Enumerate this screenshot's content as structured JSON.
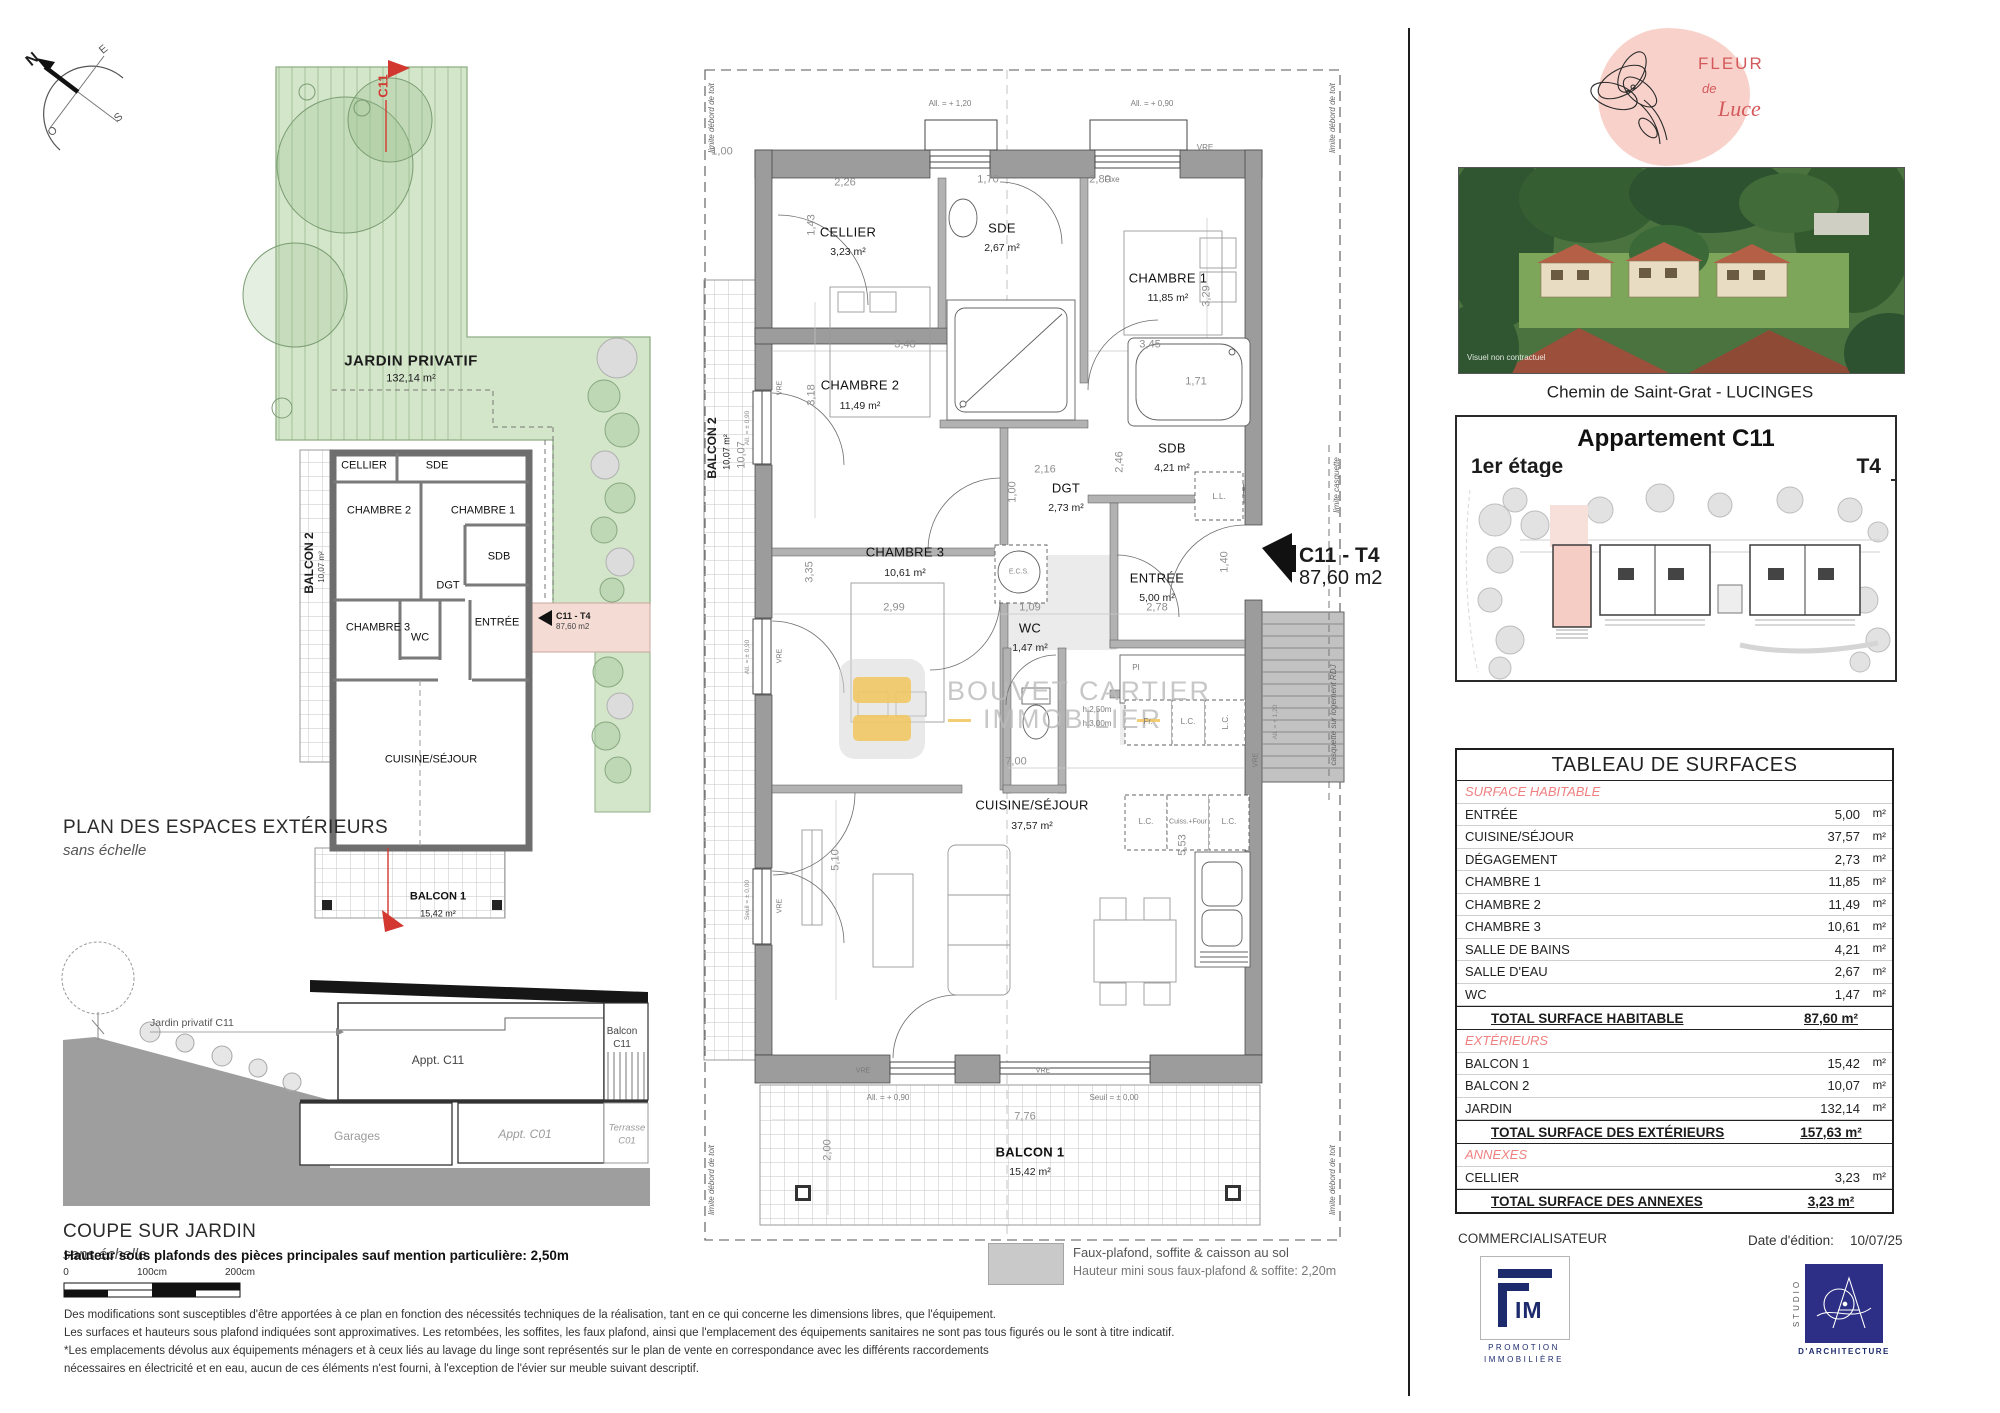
{
  "colors": {
    "accent_red": "#d23730",
    "table_section_pink": "#f08080",
    "wall_gray": "#9c9c9c",
    "jardin_green": "#d4e6ca",
    "brand_pink": "#f8d2ca",
    "brand_red": "#d4595c",
    "navy": "#1d2b6d",
    "watermark_yellow": "#f2c55c"
  },
  "brand": {
    "top": "FLEUR",
    "mid": "de",
    "script": "Luce"
  },
  "project": {
    "photo_note": "Visuel non contractuel",
    "address": "Chemin de Saint-Grat - LUCINGES",
    "title": "Appartement C11",
    "floor": "1er étage",
    "type": "T4"
  },
  "unit_tag": {
    "code": "C11 - T4",
    "area": "87,60 m2"
  },
  "compass": {
    "n": "N",
    "e": "E",
    "s": "S",
    "o": "O"
  },
  "jardin": {
    "title": "JARDIN PRIVATIF",
    "area": "132,14 m²",
    "marker": "C11"
  },
  "ext_plan": {
    "caption": "PLAN DES ESPACES EXTÉRIEURS",
    "scale_note": "sans échelle"
  },
  "coupe": {
    "caption": "COUPE SUR JARDIN",
    "scale_note": "sans échelle",
    "jardin_label": "Jardin privatif C11",
    "appt": "Appt. C11",
    "balcon_l1": "Balcon",
    "balcon_l2": "C11",
    "garages": "Garages",
    "appt_c01": "Appt. C01",
    "terrasse_l1": "Terrasse",
    "terrasse_l2": "C01"
  },
  "rooms": {
    "cellier": {
      "name": "CELLIER",
      "area": "3,23 m²"
    },
    "sde": {
      "name": "SDE",
      "area": "2,67 m²"
    },
    "chambre1": {
      "name": "CHAMBRE 1",
      "area": "11,85 m²"
    },
    "chambre2": {
      "name": "CHAMBRE 2",
      "area": "11,49 m²"
    },
    "sdb": {
      "name": "SDB",
      "area": "4,21 m²"
    },
    "dgt": {
      "name": "DGT",
      "area": "2,73 m²"
    },
    "chambre3": {
      "name": "CHAMBRE 3",
      "area": "10,61 m²"
    },
    "wc": {
      "name": "WC",
      "area": "1,47 m²"
    },
    "entree": {
      "name": "ENTRÉE",
      "area": "5,00 m²"
    },
    "cuisine": {
      "name": "CUISINE/SÉJOUR",
      "area": "37,57 m²"
    },
    "balcon1": {
      "name": "BALCON 1",
      "area": "15,42 m²"
    },
    "balcon2": {
      "name": "BALCON 2",
      "area": "10,07 m²",
      "dim": "10,07"
    }
  },
  "dims": {
    "d100": "1,00",
    "d226": "2,26",
    "d170": "1,70",
    "d280": "2,80",
    "d143": "1,43",
    "d348": "3,48",
    "d345": "3,45",
    "d318": "3,18",
    "d329": "3,29",
    "d171": "1,71",
    "d246": "2,46",
    "d216": "2,16",
    "d299": "2,99",
    "d109": "1,09",
    "d278": "2,78",
    "d140": "1,40",
    "d335": "3,35",
    "d510": "5,10",
    "d700": "7,00",
    "d553": "5,53",
    "d776": "7,76",
    "d200": "2,00"
  },
  "ann": {
    "all120": "All. = + 1,20",
    "all090": "All. = + 0,90",
    "all090pm": "All. = ± 0,90",
    "vre": "VRE",
    "fixe": "Fixe",
    "ecs": "E.C.S.",
    "ll": "L.L.",
    "pi": "PI",
    "fr": "Fr.",
    "lc": "L.C.",
    "cuiss": "Cuiss.+Four",
    "h250": "h:2,50m",
    "h300": "h:3,00m",
    "seuil": "Seuil = ± 0,00",
    "limite_toit": "limite débord de toit",
    "limite_casquette": "limite casquette",
    "casquette_rdj": "casquette sur logement RDJ"
  },
  "surface_table": {
    "title": "TABLEAU DE SURFACES",
    "sections": [
      {
        "header": "SURFACE HABITABLE",
        "rows": [
          {
            "label": "ENTRÉE",
            "value": "5,00",
            "unit": "m²"
          },
          {
            "label": "CUISINE/SÉJOUR",
            "value": "37,57",
            "unit": "m²"
          },
          {
            "label": "DÉGAGEMENT",
            "value": "2,73",
            "unit": "m²"
          },
          {
            "label": "CHAMBRE 1",
            "value": "11,85",
            "unit": "m²"
          },
          {
            "label": "CHAMBRE 2",
            "value": "11,49",
            "unit": "m²"
          },
          {
            "label": "CHAMBRE 3",
            "value": "10,61",
            "unit": "m²"
          },
          {
            "label": "SALLE DE BAINS",
            "value": "4,21",
            "unit": "m²"
          },
          {
            "label": "SALLE D'EAU",
            "value": "2,67",
            "unit": "m²"
          },
          {
            "label": "WC",
            "value": "1,47",
            "unit": "m²"
          }
        ],
        "total_label": "TOTAL SURFACE HABITABLE",
        "total_value": "87,60 m²"
      },
      {
        "header": "EXTÉRIEURS",
        "rows": [
          {
            "label": "BALCON 1",
            "value": "15,42",
            "unit": "m²"
          },
          {
            "label": "BALCON 2",
            "value": "10,07",
            "unit": "m²"
          },
          {
            "label": "JARDIN",
            "value": "132,14",
            "unit": "m²"
          }
        ],
        "total_label": "TOTAL SURFACE DES EXTÉRIEURS",
        "total_value": "157,63 m²"
      },
      {
        "header": "ANNEXES",
        "rows": [
          {
            "label": "CELLIER",
            "value": "3,23",
            "unit": "m²"
          }
        ],
        "total_label": "TOTAL SURFACE DES ANNEXES",
        "total_value": "3,23 m²"
      }
    ]
  },
  "legend": {
    "line1": "Faux-plafond, soffite & caisson au sol",
    "line2": "Hauteur mini sous faux-plafond & soffite: 2,20m"
  },
  "notes": {
    "ceiling": "Hauteur sous plafonds des pièces principales sauf mention particulière: 2,50m",
    "lines": [
      "Des modifications sont susceptibles d'être apportées à ce plan en fonction des nécessités techniques de la réalisation, tant en ce qui concerne les dimensions libres, que l'équipement.",
      "Les surfaces et hauteurs sous plafond indiquées sont approximatives. Les retombées, les soffites, les faux plafond, ainsi que l'emplacement des équipements sanitaires ne sont pas tous figurés ou le sont à titre indicatif.",
      "*Les emplacements dévolus aux équipements ménagers et à ceux liés au lavage du linge sont représentés sur le plan de vente en correspondance avec les différents raccordements",
      "nécessaires en électricité et en eau, aucun de ces éléments n'est fourni, à l'exception de l'évier sur meuble suivant descriptif."
    ]
  },
  "scalebar": {
    "zero": "0",
    "l100": "100cm",
    "l200": "200cm"
  },
  "watermark": {
    "line1": "BOUVET CARTIER",
    "line2": "IMMOBILIER"
  },
  "footer": {
    "commercial": "COMMERCIALISATEUR",
    "fim_im": "IM",
    "promo1": "PROMOTION",
    "promo2": "IMMOBILIÈRE",
    "date_label": "Date d'édition:",
    "date_value": "10/07/25",
    "studio": "STUDIO",
    "darch": "D'ARCHITECTURE"
  }
}
